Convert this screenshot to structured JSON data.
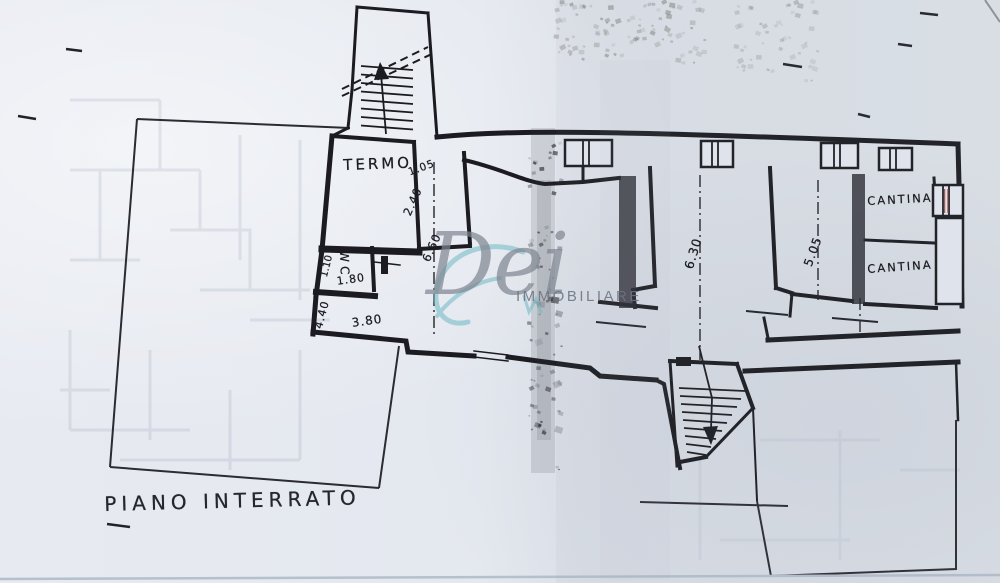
{
  "document": {
    "kind": "scanned basement floor plan",
    "title": "PIANO INTERRATO"
  },
  "watermark": {
    "script": "Dei",
    "caption": "IMMOBILIARE"
  },
  "plan_labels": {
    "room_labels": [
      {
        "text": "TERMO",
        "x": 343,
        "y": 158,
        "rot": -2,
        "size": 15,
        "ls": 3
      },
      {
        "text": "WC",
        "x": 350,
        "y": 250,
        "rot": 88,
        "size": 12,
        "ls": 4
      },
      {
        "text": "CANTINA",
        "x": 867,
        "y": 196,
        "rot": -3,
        "size": 11.5,
        "ls": 2
      },
      {
        "text": "CANTINA",
        "x": 867,
        "y": 264,
        "rot": -4,
        "size": 11.5,
        "ls": 2
      }
    ],
    "dimension_labels": [
      {
        "text": "1.05",
        "x": 407,
        "y": 168,
        "rot": -20,
        "size": 10.5,
        "ls": 1
      },
      {
        "text": "2.40",
        "x": 402,
        "y": 213,
        "rot": -66,
        "size": 11.5,
        "ls": 1
      },
      {
        "text": "6.60",
        "x": 421,
        "y": 259,
        "rot": -66,
        "size": 11.5,
        "ls": 1
      },
      {
        "text": "1.10",
        "x": 320,
        "y": 276,
        "rot": -76,
        "size": 10,
        "ls": 0
      },
      {
        "text": "1.80",
        "x": 336,
        "y": 276,
        "rot": -8,
        "size": 11,
        "ls": 1
      },
      {
        "text": "4.40",
        "x": 313,
        "y": 327,
        "rot": -75,
        "size": 11,
        "ls": 1
      },
      {
        "text": "3.80",
        "x": 351,
        "y": 317,
        "rot": -8,
        "size": 12,
        "ls": 1
      },
      {
        "text": "6.30",
        "x": 683,
        "y": 267,
        "rot": -73,
        "size": 12.5,
        "ls": 1
      },
      {
        "text": "5.05",
        "x": 802,
        "y": 264,
        "rot": -70,
        "size": 12,
        "ls": 1
      }
    ],
    "handwritten_notes": [
      {
        "text": "PIANO INTERRATO",
        "x": 104,
        "y": 494,
        "rot": -1.5,
        "size": 20,
        "ls": 5,
        "cut": false
      },
      {
        "text": "LOM",
        "x": 596,
        "y": -6,
        "rot": -62,
        "size": 21,
        "ls": 2,
        "cut": true
      }
    ]
  },
  "colors": {
    "ink": "#1c1d23",
    "paper": "#e4e8ef",
    "fold": "#3c3d46",
    "bleed": "#5f6b8e",
    "watermark_gray": "#838b96",
    "watermark_teal": "#6fb9c4",
    "accent_red": "#8a3a34"
  }
}
